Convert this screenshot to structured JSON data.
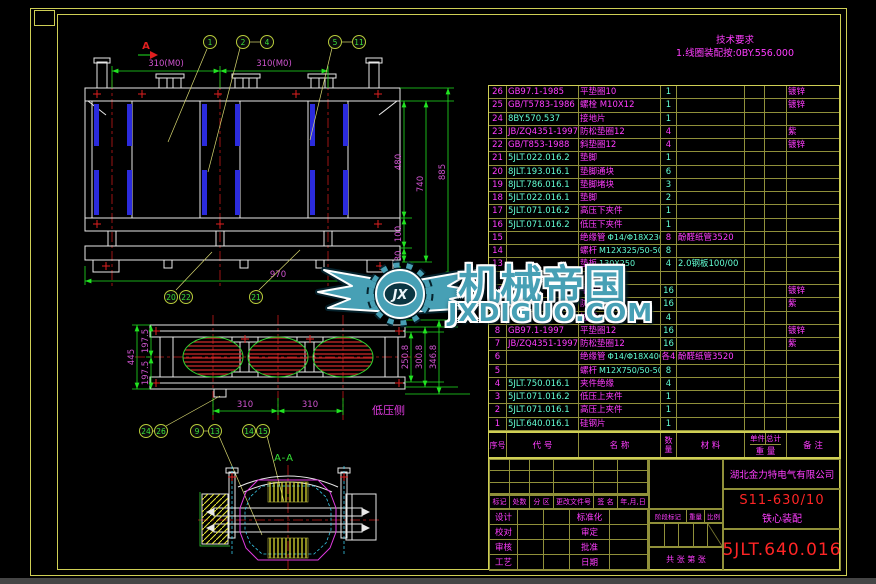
{
  "tech_req": {
    "title": "技术要求",
    "line": "1.线圈装配按:0BY.556.000"
  },
  "watermark": {
    "logo_text": "JX",
    "title": "机械帝国",
    "domain": "JXDIGUO.COM"
  },
  "colors": {
    "magenta": "#ff3dff",
    "cyan": "#63ffd4",
    "green": "#21e321",
    "red": "#e01f1f",
    "frame_yellow": "#cfcf55",
    "table_line": "#90903a",
    "blue": "#2b2bdd",
    "dim_text": "#cf54cf",
    "watermark_teal": "#47a0b5"
  },
  "parts_table": {
    "header": {
      "num": "序号",
      "code": "代  号",
      "name": "名  称",
      "qty": "数量",
      "material": "材  料",
      "unit": "单件",
      "total": "总计",
      "weight": "重 量",
      "remark": "备  注"
    },
    "rows": [
      {
        "num": "26",
        "code": "GB97.1-1985",
        "ccol": "m",
        "name": "平垫圈10",
        "qty": "1",
        "qcol": "c",
        "rem": "镀锌"
      },
      {
        "num": "25",
        "code": "GB/T5783-1986",
        "ccol": "m",
        "name": "螺栓 M10X12",
        "qty": "1",
        "qcol": "c",
        "rem": "镀锌"
      },
      {
        "num": "24",
        "code": "8BY.570.537",
        "ccol": "c",
        "name": "接地片",
        "qty": "1",
        "qcol": "c"
      },
      {
        "num": "23",
        "code": "JB/ZQ4351-1997",
        "ccol": "m",
        "name": "防松垫圈12",
        "qty": "4",
        "qcol": "m",
        "rem": "紫"
      },
      {
        "num": "22",
        "code": "GB/T853-1988",
        "ccol": "m",
        "name": "斜垫圈12",
        "qty": "4",
        "qcol": "m",
        "rem": "镀锌"
      },
      {
        "num": "21",
        "code": "5JLT.022.016.2",
        "ccol": "c",
        "name": "垫脚",
        "qty": "1",
        "qcol": "c"
      },
      {
        "num": "20",
        "code": "8JLT.193.016.1",
        "ccol": "c",
        "name": "垫脚通块",
        "qty": "6",
        "qcol": "c"
      },
      {
        "num": "19",
        "code": "8JLT.786.016.1",
        "ccol": "c",
        "name": "垫脚堵块",
        "qty": "3",
        "qcol": "c"
      },
      {
        "num": "18",
        "code": "5JLT.022.016.1",
        "ccol": "c",
        "name": "垫脚",
        "qty": "2",
        "qcol": "c"
      },
      {
        "num": "17",
        "code": "5JLT.071.016.2",
        "ccol": "c",
        "name": "高压下夹件",
        "qty": "1",
        "qcol": "c"
      },
      {
        "num": "16",
        "code": "5JLT.071.016.2",
        "ccol": "c",
        "name": "低压下夹件",
        "qty": "1",
        "qcol": "c"
      },
      {
        "num": "15",
        "code": "",
        "name": "绝缘管",
        "name2": "Φ14/Φ18X230",
        "qty": "8",
        "qcol": "m",
        "mat": "酚醛纸管3520"
      },
      {
        "num": "14",
        "code": "",
        "name": "螺杆",
        "name2": "M12X325/50-50",
        "qty": "8",
        "qcol": "c"
      },
      {
        "num": "13",
        "code": "",
        "name": "垫板",
        "name2": "130X250",
        "qty": "4",
        "qcol": "c",
        "mat": "2.0钢板100/00",
        "matcol": "c"
      },
      {
        "num": "",
        "code": "",
        "name": "",
        "qty": ""
      },
      {
        "num": "11",
        "code": "",
        "name": "平垫圈10",
        "qty": "16",
        "qcol": "c",
        "rem": "镀锌"
      },
      {
        "num": "10",
        "code": "",
        "name": "防松垫圈10",
        "qty": "16",
        "qcol": "c",
        "rem": "紫"
      },
      {
        "num": "9",
        "code": "",
        "name": "拉带",
        "qty": "4",
        "qcol": "c"
      },
      {
        "num": "8",
        "code": "GB97.1-1997",
        "ccol": "m",
        "name": "平垫圈12",
        "qty": "16",
        "qcol": "c",
        "rem": "镀锌"
      },
      {
        "num": "7",
        "code": "JB/ZQ4351-1997",
        "ccol": "m",
        "name": "防松垫圈12",
        "qty": "16",
        "qcol": "c",
        "rem": "紫"
      },
      {
        "num": "6",
        "code": "",
        "name": "绝缘管",
        "name2": "Φ14/Φ18X400.460",
        "qty": "各4",
        "qcol": "m",
        "mat": "酚醛纸管3520"
      },
      {
        "num": "5",
        "code": "",
        "name": "螺杆",
        "name2": "M12X750/50-50",
        "qty": "8",
        "qcol": "c"
      },
      {
        "num": "4",
        "code": "5JLT.750.016.1",
        "ccol": "c",
        "name": "夹件绝缘",
        "qty": "4",
        "qcol": "c"
      },
      {
        "num": "3",
        "code": "5JLT.071.016.2",
        "ccol": "c",
        "name": "低压上夹件",
        "qty": "1",
        "qcol": "c"
      },
      {
        "num": "2",
        "code": "5JLT.071.016.1",
        "ccol": "c",
        "name": "高压上夹件",
        "qty": "1",
        "qcol": "c"
      },
      {
        "num": "1",
        "code": "5JLT.640.016.1",
        "ccol": "c",
        "name": "硅钢片",
        "qty": "1",
        "qcol": "c"
      }
    ]
  },
  "title_block": {
    "company": "湖北金力特电气有限公司",
    "model": "S11-630/10",
    "title": "铁心装配",
    "drawing_no": "5JLT.640.016",
    "rev_labels": [
      "标记",
      "处数",
      "分 区",
      "更改文件号",
      "签 名",
      "年,月,日"
    ],
    "sign_rows": [
      [
        "设计",
        "标准化"
      ],
      [
        "校对",
        "审定"
      ],
      [
        "审核",
        "批准"
      ],
      [
        "工艺",
        "日期"
      ]
    ],
    "stage": {
      "stage": "阶段标记",
      "weight": "重量",
      "scale": "比例",
      "sheets": "共  张  第  张"
    }
  },
  "front_view": {
    "section_arrow": "A",
    "balloons_top": [
      "1",
      "2",
      "4",
      "5",
      "11"
    ],
    "balloons_bottom": [
      "20",
      "22",
      "21"
    ],
    "dims": {
      "p1": "310(M0)",
      "p2": "310(M0)",
      "h480": "480",
      "h100": "100",
      "h30": "30",
      "h740": "740",
      "h885": "885",
      "w970": "970"
    }
  },
  "plan_view": {
    "balloons": [
      "24",
      "26",
      "9",
      "13",
      "14",
      "15"
    ],
    "lv_label": "低压侧",
    "dims": {
      "total_left": "445",
      "upper_left": "197.5",
      "lower_left": "197.5",
      "r1": "250.8",
      "r2": "300.8",
      "r3": "346.8",
      "b1": "310",
      "b2": "310"
    }
  },
  "section_view": {
    "label": "A-A"
  }
}
